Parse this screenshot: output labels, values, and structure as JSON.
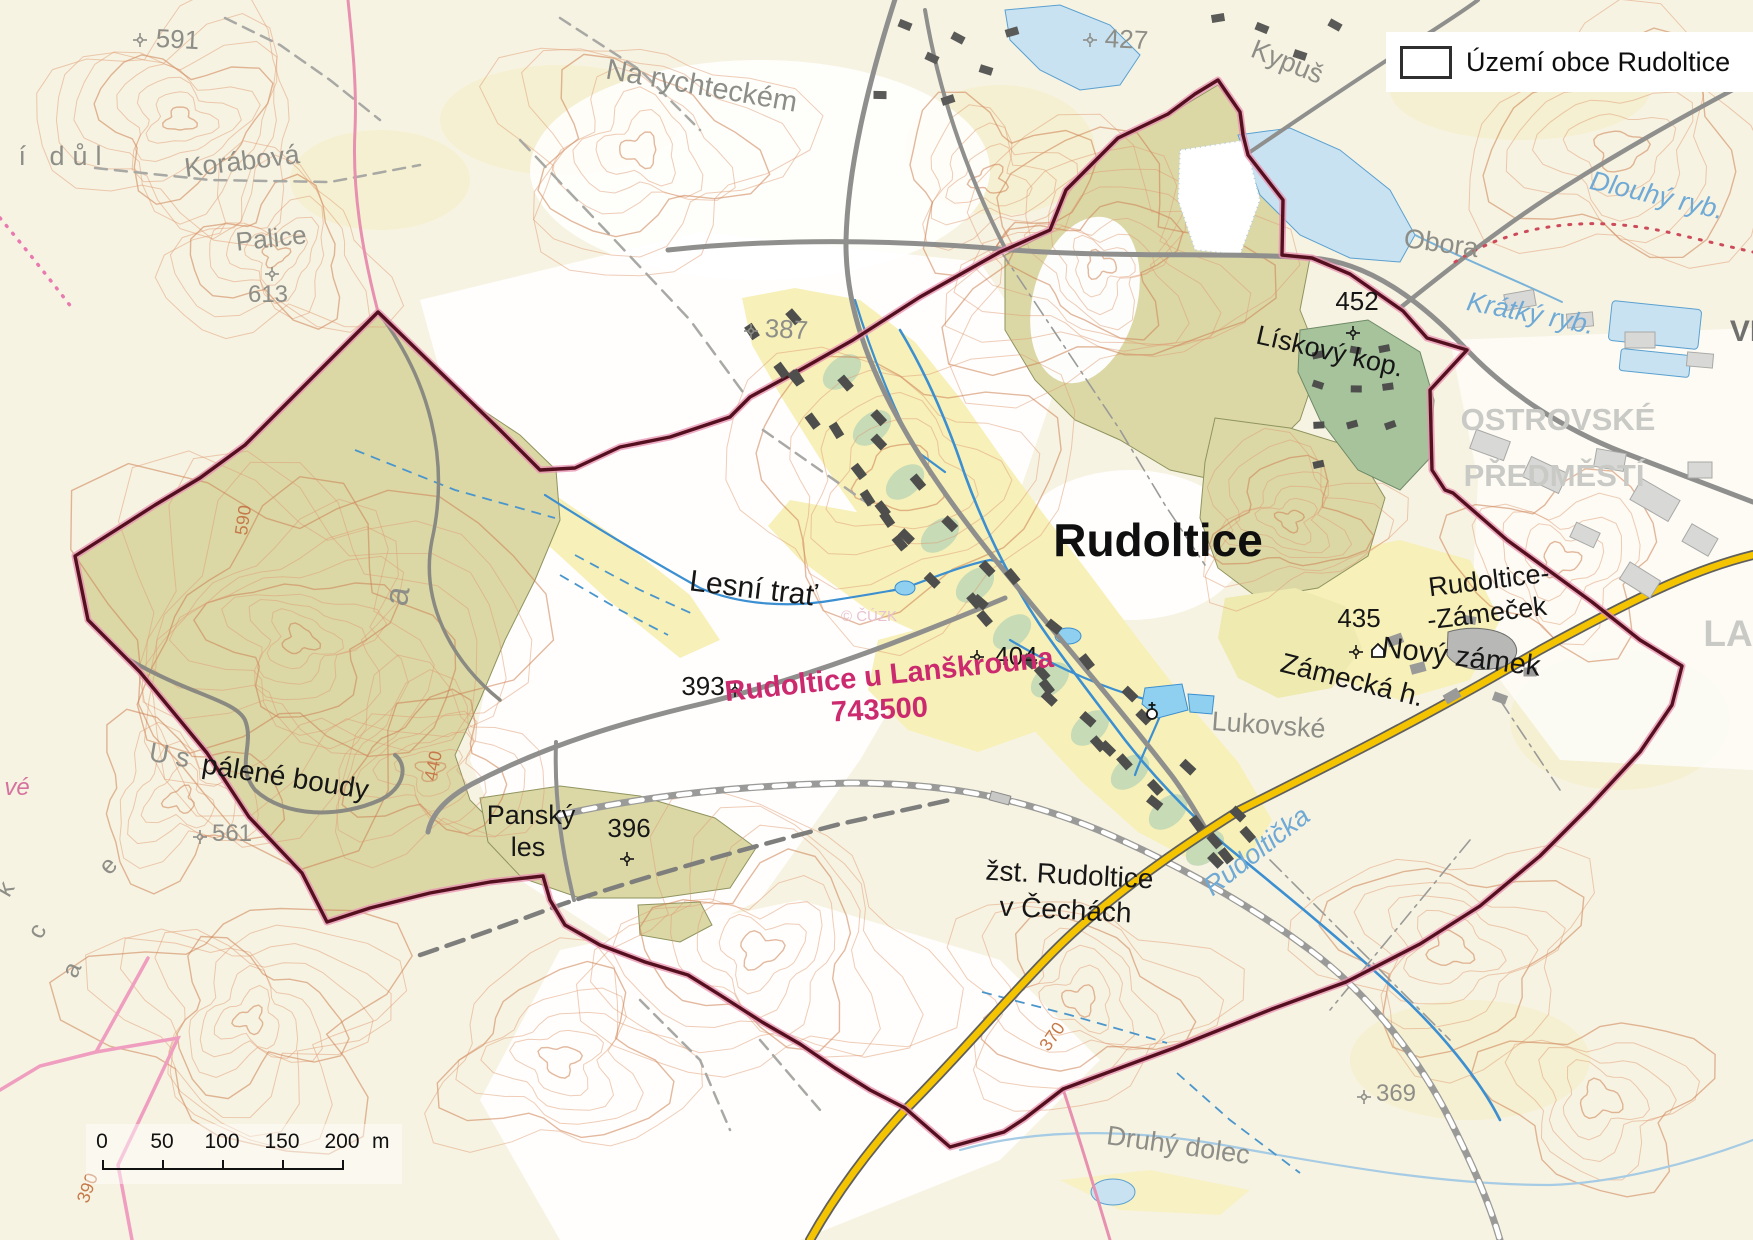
{
  "legend": {
    "title": "Území obce Rudoltice"
  },
  "scalebar": {
    "ticks": [
      "0",
      "50",
      "100",
      "150",
      "200"
    ],
    "unit": "m"
  },
  "watermark": "© ČÚZK",
  "colors": {
    "boundary_inner": "#551020",
    "boundary_glow": "#e890b0",
    "forest": "#dbd8a6",
    "allotment": "#a6c39c",
    "garden": "#c3d9b5",
    "field_yellow": "#f7f0b8",
    "pond": "#c8e2f2",
    "stream": "#3c8fd0",
    "contour": "#df9b73",
    "road_major_fill": "#f5c400",
    "road_gray": "#8f8f8d",
    "cadastral_text": "#cc2a6e"
  },
  "labels": [
    {
      "text": "Na rychteckém",
      "x": 700,
      "y": 95,
      "s": 29,
      "rot": 10,
      "cls": "place"
    },
    {
      "text": "Korábová",
      "x": 243,
      "y": 170,
      "s": 27,
      "rot": -7,
      "cls": "place"
    },
    {
      "text": "Palice",
      "x": 272,
      "y": 247,
      "s": 26,
      "rot": -6,
      "cls": "place"
    },
    {
      "text": "613",
      "x": 268,
      "y": 302,
      "s": 24,
      "rot": 0,
      "cls": "place"
    },
    {
      "text": "591",
      "x": 177,
      "y": 48,
      "s": 26,
      "rot": 3,
      "cls": "place"
    },
    {
      "text": "í důl",
      "x": 64,
      "y": 165,
      "s": 27,
      "rot": 0,
      "cls": "place",
      "ls": 8
    },
    {
      "text": "427",
      "x": 1126,
      "y": 48,
      "s": 26,
      "rot": 3,
      "cls": "place"
    },
    {
      "text": "Kypuš",
      "x": 1284,
      "y": 70,
      "s": 27,
      "rot": 22,
      "cls": "place"
    },
    {
      "text": "Obora",
      "x": 1440,
      "y": 252,
      "s": 27,
      "rot": 8,
      "cls": "place"
    },
    {
      "text": "387",
      "x": 786,
      "y": 338,
      "s": 26,
      "rot": 3,
      "cls": "place"
    },
    {
      "text": "Lukovské",
      "x": 1268,
      "y": 734,
      "s": 27,
      "rot": 4,
      "cls": "place"
    },
    {
      "text": "Druhý dolec",
      "x": 1177,
      "y": 1154,
      "s": 27,
      "rot": 8,
      "cls": "place"
    },
    {
      "text": "561",
      "x": 232,
      "y": 841,
      "s": 24,
      "rot": 0,
      "cls": "place"
    },
    {
      "text": "369",
      "x": 1396,
      "y": 1101,
      "s": 24,
      "rot": 0,
      "cls": "place"
    },
    {
      "text": "U s",
      "x": 168,
      "y": 764,
      "s": 27,
      "rot": 10,
      "cls": "place"
    },
    {
      "text": "e",
      "x": 114,
      "y": 871,
      "s": 25,
      "rot": -48,
      "cls": "place"
    },
    {
      "text": "k",
      "x": 12,
      "y": 893,
      "s": 25,
      "rot": -60,
      "cls": "place"
    },
    {
      "text": "c",
      "x": 44,
      "y": 935,
      "s": 25,
      "rot": -60,
      "cls": "place"
    },
    {
      "text": "a",
      "x": 79,
      "y": 973,
      "s": 25,
      "rot": -66,
      "cls": "place"
    },
    {
      "text": "a",
      "x": 408,
      "y": 598,
      "s": 34,
      "rot": -80,
      "cls": "place"
    },
    {
      "text": "OSTROVSKÉ",
      "x": 1558,
      "y": 430,
      "s": 31,
      "rot": 0,
      "cls": "district"
    },
    {
      "text": "PŘEDMĚSTÍ",
      "x": 1554,
      "y": 486,
      "s": 31,
      "rot": 0,
      "cls": "district"
    },
    {
      "text": "LA",
      "x": 1728,
      "y": 646,
      "s": 37,
      "rot": 0,
      "cls": "district"
    },
    {
      "text": "VI",
      "x": 1744,
      "y": 341,
      "s": 30,
      "rot": 0,
      "cls": "districtDark"
    },
    {
      "text": "vé",
      "x": 17,
      "y": 795,
      "s": 24,
      "rot": 0,
      "cls": "pinkLbl"
    },
    {
      "text": "Rudoltice",
      "x": 1158,
      "y": 556,
      "s": 46,
      "rot": 0,
      "cls": "town"
    },
    {
      "text": "Lesní trať",
      "x": 752,
      "y": 598,
      "s": 30,
      "rot": 7,
      "cls": "local"
    },
    {
      "text": "pálené boudy",
      "x": 284,
      "y": 786,
      "s": 28,
      "rot": 9,
      "cls": "local"
    },
    {
      "text": "Panský",
      "x": 531,
      "y": 824,
      "s": 27,
      "rot": 0,
      "cls": "local"
    },
    {
      "text": "les",
      "x": 528,
      "y": 856,
      "s": 27,
      "rot": 0,
      "cls": "local"
    },
    {
      "text": "396",
      "x": 629,
      "y": 837,
      "s": 26,
      "rot": 0,
      "cls": "local"
    },
    {
      "text": "393",
      "x": 703,
      "y": 695,
      "s": 26,
      "rot": 0,
      "cls": "local"
    },
    {
      "text": "404",
      "x": 1016,
      "y": 665,
      "s": 26,
      "rot": 0,
      "cls": "local"
    },
    {
      "text": "452",
      "x": 1357,
      "y": 310,
      "s": 26,
      "rot": 0,
      "cls": "local"
    },
    {
      "text": "Lískový kop.",
      "x": 1328,
      "y": 360,
      "s": 27,
      "rot": 13,
      "cls": "local"
    },
    {
      "text": "435",
      "x": 1359,
      "y": 627,
      "s": 26,
      "rot": 0,
      "cls": "local"
    },
    {
      "text": "Nový zámek",
      "x": 1460,
      "y": 666,
      "s": 29,
      "rot": 7,
      "cls": "local"
    },
    {
      "text": "Zámecká h.",
      "x": 1350,
      "y": 689,
      "s": 28,
      "rot": 14,
      "cls": "local"
    },
    {
      "text": "Rudoltice-",
      "x": 1490,
      "y": 589,
      "s": 27,
      "rot": -7,
      "cls": "local"
    },
    {
      "text": "-Zámeček",
      "x": 1488,
      "y": 622,
      "s": 27,
      "rot": -7,
      "cls": "local"
    },
    {
      "text": "žst. Rudoltice",
      "x": 1069,
      "y": 884,
      "s": 28,
      "rot": 3,
      "cls": "local"
    },
    {
      "text": "v Čechách",
      "x": 1065,
      "y": 919,
      "s": 28,
      "rot": 3,
      "cls": "local"
    },
    {
      "text": "Dlouhý ryb.",
      "x": 1655,
      "y": 204,
      "s": 27,
      "rot": 13,
      "cls": "water"
    },
    {
      "text": "Krátký ryb.",
      "x": 1529,
      "y": 322,
      "s": 27,
      "rot": 11,
      "cls": "water"
    },
    {
      "text": "Rudoltička",
      "x": 1262,
      "y": 858,
      "s": 27,
      "rot": -38,
      "cls": "water"
    },
    {
      "text": "Rudoltice u Lanškrouna",
      "x": 890,
      "y": 684,
      "s": 29,
      "rot": -6,
      "cls": "cadastral"
    },
    {
      "text": "743500",
      "x": 880,
      "y": 719,
      "s": 29,
      "rot": -3,
      "cls": "cadastral"
    },
    {
      "text": "590",
      "x": 249,
      "y": 521,
      "s": 18,
      "rot": -82,
      "cls": "contourLbl"
    },
    {
      "text": "440",
      "x": 439,
      "y": 767,
      "s": 18,
      "rot": -78,
      "cls": "contourLbl"
    },
    {
      "text": "370",
      "x": 1057,
      "y": 1040,
      "s": 18,
      "rot": -55,
      "cls": "contourLbl"
    },
    {
      "text": "390",
      "x": 93,
      "y": 1190,
      "s": 18,
      "rot": -70,
      "cls": "contourLbl"
    },
    {
      "text": "© ČÚZK",
      "x": 869,
      "y": 621,
      "s": 15,
      "rot": 0,
      "cls": "watermark"
    }
  ],
  "spot_heights": [
    {
      "x": 140,
      "y": 40,
      "tone": "gray"
    },
    {
      "x": 1090,
      "y": 40,
      "tone": "gray"
    },
    {
      "x": 751,
      "y": 331,
      "tone": "gray"
    },
    {
      "x": 272,
      "y": 274,
      "tone": "gray"
    },
    {
      "x": 200,
      "y": 837,
      "tone": "gray"
    },
    {
      "x": 1364,
      "y": 1097,
      "tone": "gray"
    },
    {
      "x": 735,
      "y": 690,
      "tone": "dark"
    },
    {
      "x": 977,
      "y": 657,
      "tone": "dark"
    },
    {
      "x": 1353,
      "y": 333,
      "tone": "dark"
    },
    {
      "x": 1356,
      "y": 652,
      "tone": "dark"
    },
    {
      "x": 627,
      "y": 859,
      "tone": "dark"
    }
  ],
  "poi_symbols": {
    "chapel": {
      "x": 1378,
      "y": 652
    },
    "church": {
      "x": 1152,
      "y": 714
    }
  }
}
